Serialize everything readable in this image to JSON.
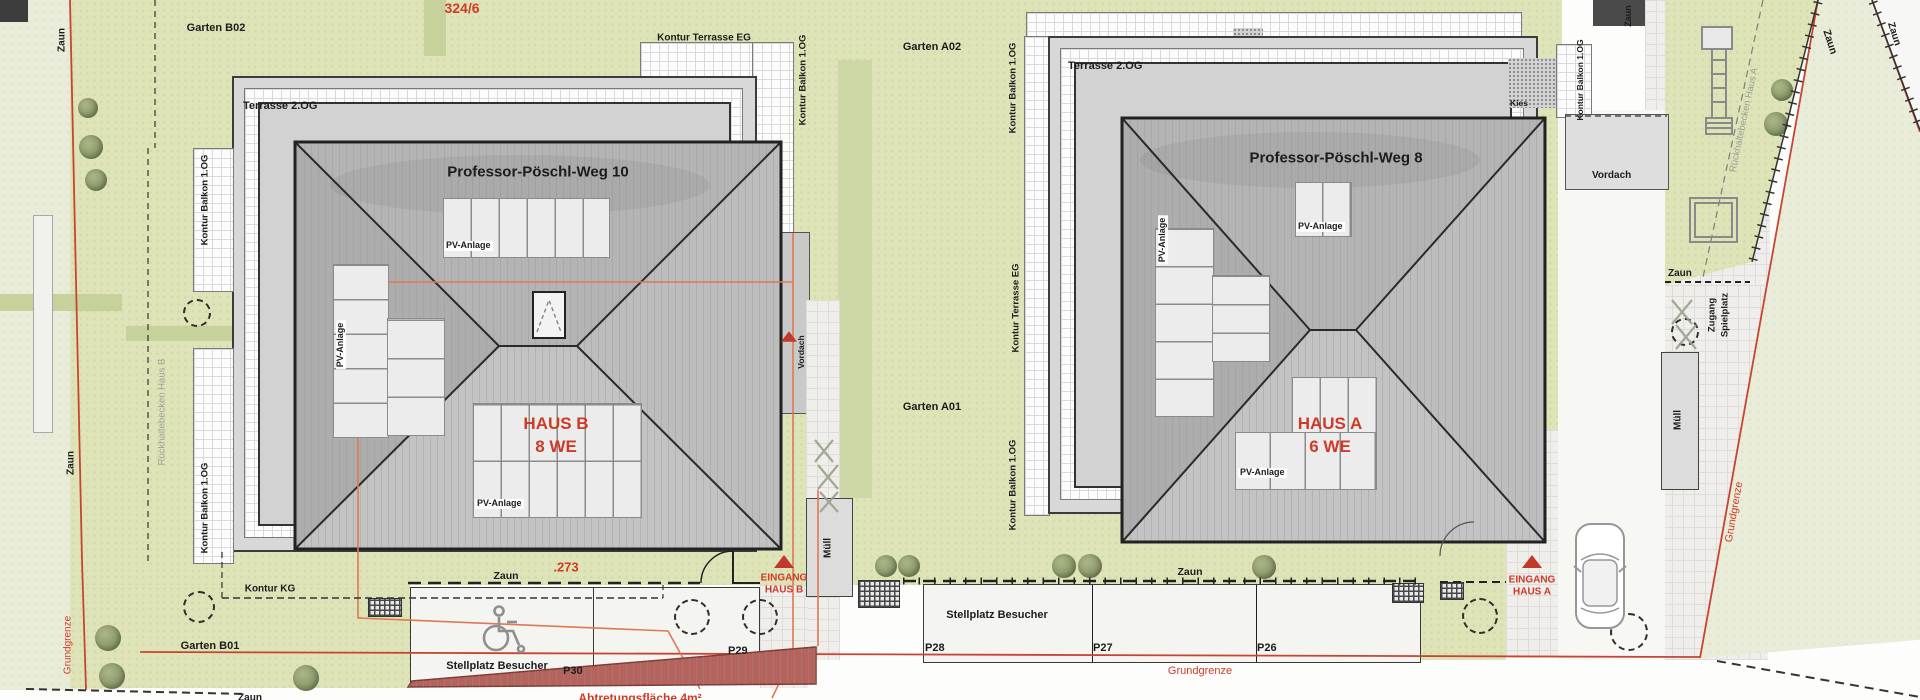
{
  "plan": {
    "parcel_number": "324/6",
    "dimension": ".273",
    "grundgrenze": "Grundgrenze",
    "zaun": "Zaun",
    "kontur_kg": "Kontur KG",
    "abtretung": "Abtretungsfläche 4m²",
    "stellplatz_besucher": "Stellplatz Besucher",
    "p26": "P26",
    "p27": "P27",
    "p28": "P28",
    "p29": "P29",
    "p30": "P30"
  },
  "haus_b": {
    "title": "Professor-Pöschl-Weg 10",
    "name": "HAUS B",
    "units": "8 WE",
    "terrasse": "Terrasse 2.OG",
    "kontur_terrasse": "Kontur Terrasse EG",
    "kontur_balkon": "Kontur Balkon 1.OG",
    "pv": "PV-Anlage",
    "eingang1": "EINGANG",
    "eingang2": "HAUS B",
    "muell": "Müll",
    "vordach": "Vordach",
    "rueckhaltebecken": "Rückhaltebecken Haus B",
    "garten_top": "Garten B02",
    "garten_bottom": "Garten B01"
  },
  "haus_a": {
    "title": "Professor-Pöschl-Weg 8",
    "name": "HAUS A",
    "units": "6 WE",
    "terrasse": "Terrasse 2.OG",
    "kontur_terrasse": "Kontur Terrasse EG",
    "kontur_balkon": "Kontur Balkon 1.OG",
    "pv": "PV-Anlage",
    "eingang1": "EINGANG",
    "eingang2": "HAUS A",
    "muell": "Müll",
    "vordach": "Vordach",
    "kies": "Kies",
    "rueckhaltebecken": "Rückhaltebecken Haus A",
    "garten_top": "Garten A02",
    "garten_bottom": "Garten A01",
    "zugang1": "Zugang",
    "zugang2": "Spielplatz"
  },
  "icons": {
    "car": "car-top-view",
    "wheelchair": "accessible-parking",
    "entrance_marker": "red-triangle-arrow",
    "tree": "tree-canopy",
    "planned_tree": "dashed-circle-tree"
  }
}
